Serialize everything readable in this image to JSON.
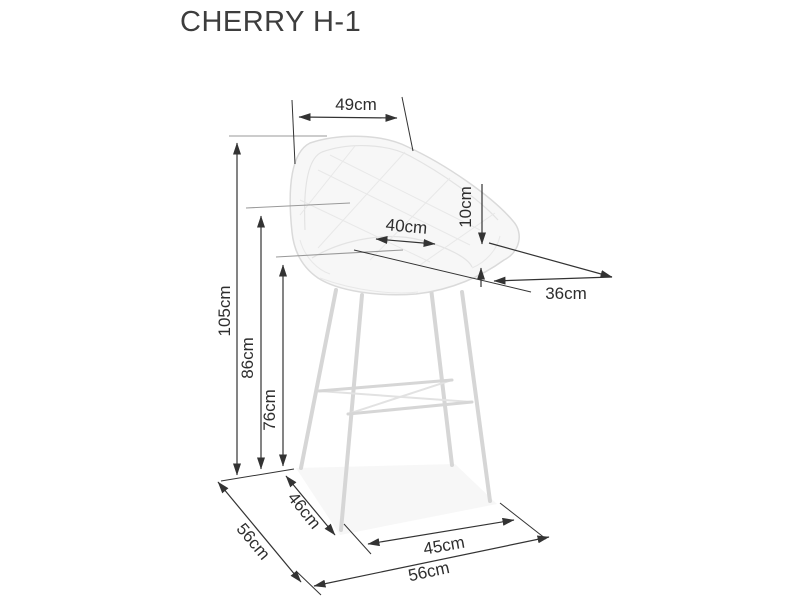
{
  "title": "CHERRY H-1",
  "dimensions": {
    "backrest_width": "49cm",
    "overall_height": "105cm",
    "back_height": "86cm",
    "seat_height": "76cm",
    "seat_width": "40cm",
    "backrest_thickness": "10cm",
    "seat_depth": "36cm",
    "side_leg_span": "46cm",
    "overall_depth": "56cm",
    "front_leg_span": "45cm",
    "overall_width": "56cm"
  },
  "colors": {
    "background": "#ffffff",
    "dimension_line": "#333333",
    "extension_line": "#999999",
    "chair_outline": "#dadada",
    "chair_fill": "#f7f7f7",
    "label_text": "#2e2e2e",
    "title_text": "#3d3d3d"
  }
}
